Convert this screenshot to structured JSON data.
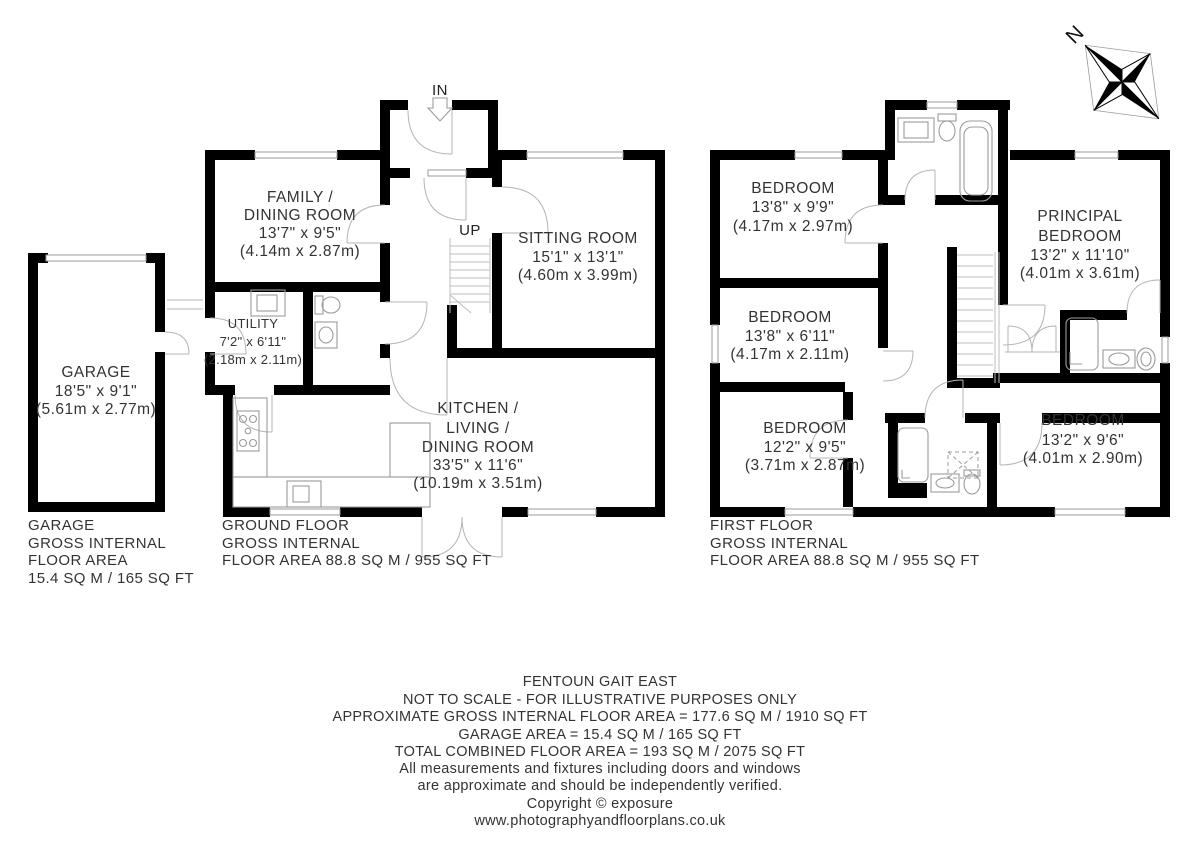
{
  "compass": {
    "north_label": "N"
  },
  "garage": {
    "room": {
      "lines": [
        "GARAGE",
        "18'5\" x 9'1\"",
        "(5.61m x 2.77m)"
      ]
    },
    "area": {
      "lines": [
        "GARAGE",
        "GROSS INTERNAL",
        "FLOOR AREA",
        "15.4 SQ M / 165 SQ FT"
      ]
    }
  },
  "ground_floor": {
    "entrance_label": "IN",
    "stairs_label": "UP",
    "rooms": [
      {
        "id": "family-dining-room",
        "lines": [
          "FAMILY /",
          "DINING ROOM",
          "13'7\" x 9'5\"",
          "(4.14m x 2.87m)"
        ]
      },
      {
        "id": "sitting-room",
        "lines": [
          "SITTING ROOM",
          "15'1\" x 13'1\"",
          "(4.60m x 3.99m)"
        ]
      },
      {
        "id": "utility",
        "lines": [
          "UTILITY",
          "7'2\" x 6'11\"",
          "(2.18m x 2.11m)"
        ]
      },
      {
        "id": "kitchen-living-dining-room",
        "lines": [
          "KITCHEN /",
          "LIVING /",
          "DINING ROOM",
          "33'5\" x 11'6\"",
          "(10.19m x 3.51m)"
        ]
      }
    ],
    "area": {
      "lines": [
        "GROUND FLOOR",
        "GROSS INTERNAL",
        "FLOOR AREA 88.8 SQ M / 955 SQ FT"
      ]
    }
  },
  "first_floor": {
    "rooms": [
      {
        "id": "bedroom-1",
        "lines": [
          "BEDROOM",
          "13'8\" x 9'9\"",
          "(4.17m x 2.97m)"
        ]
      },
      {
        "id": "principal-bedroom",
        "lines": [
          "PRINCIPAL",
          "BEDROOM",
          "13'2\" x 11'10\"",
          "(4.01m x 3.61m)"
        ]
      },
      {
        "id": "bedroom-2",
        "lines": [
          "BEDROOM",
          "13'8\" x 6'11\"",
          "(4.17m x 2.11m)"
        ]
      },
      {
        "id": "bedroom-3",
        "lines": [
          "BEDROOM",
          "12'2\" x 9'5\"",
          "(3.71m x 2.87m)"
        ]
      },
      {
        "id": "bedroom-4",
        "lines": [
          "BEDROOM",
          "13'2\" x 9'6\"",
          "(4.01m x 2.90m)"
        ]
      }
    ],
    "area": {
      "lines": [
        "FIRST FLOOR",
        "GROSS INTERNAL",
        "FLOOR AREA 88.8 SQ M / 955 SQ FT"
      ]
    }
  },
  "footer": {
    "lines": [
      "FENTOUN GAIT EAST",
      "NOT TO SCALE - FOR ILLUSTRATIVE PURPOSES ONLY",
      "APPROXIMATE GROSS INTERNAL FLOOR AREA = 177.6 SQ M / 1910 SQ FT",
      "GARAGE AREA = 15.4 SQ M / 165 SQ FT",
      "TOTAL COMBINED FLOOR AREA = 193 SQ M / 2075 SQ FT",
      "All measurements and fixtures including doors and windows",
      "are approximate and should be independently verified.",
      "Copyright © exposure",
      "www.photographyandfloorplans.co.uk"
    ]
  },
  "colors": {
    "wall": "#000000",
    "fixture": "#9b9b9b",
    "text": "#333333",
    "background": "#ffffff"
  }
}
